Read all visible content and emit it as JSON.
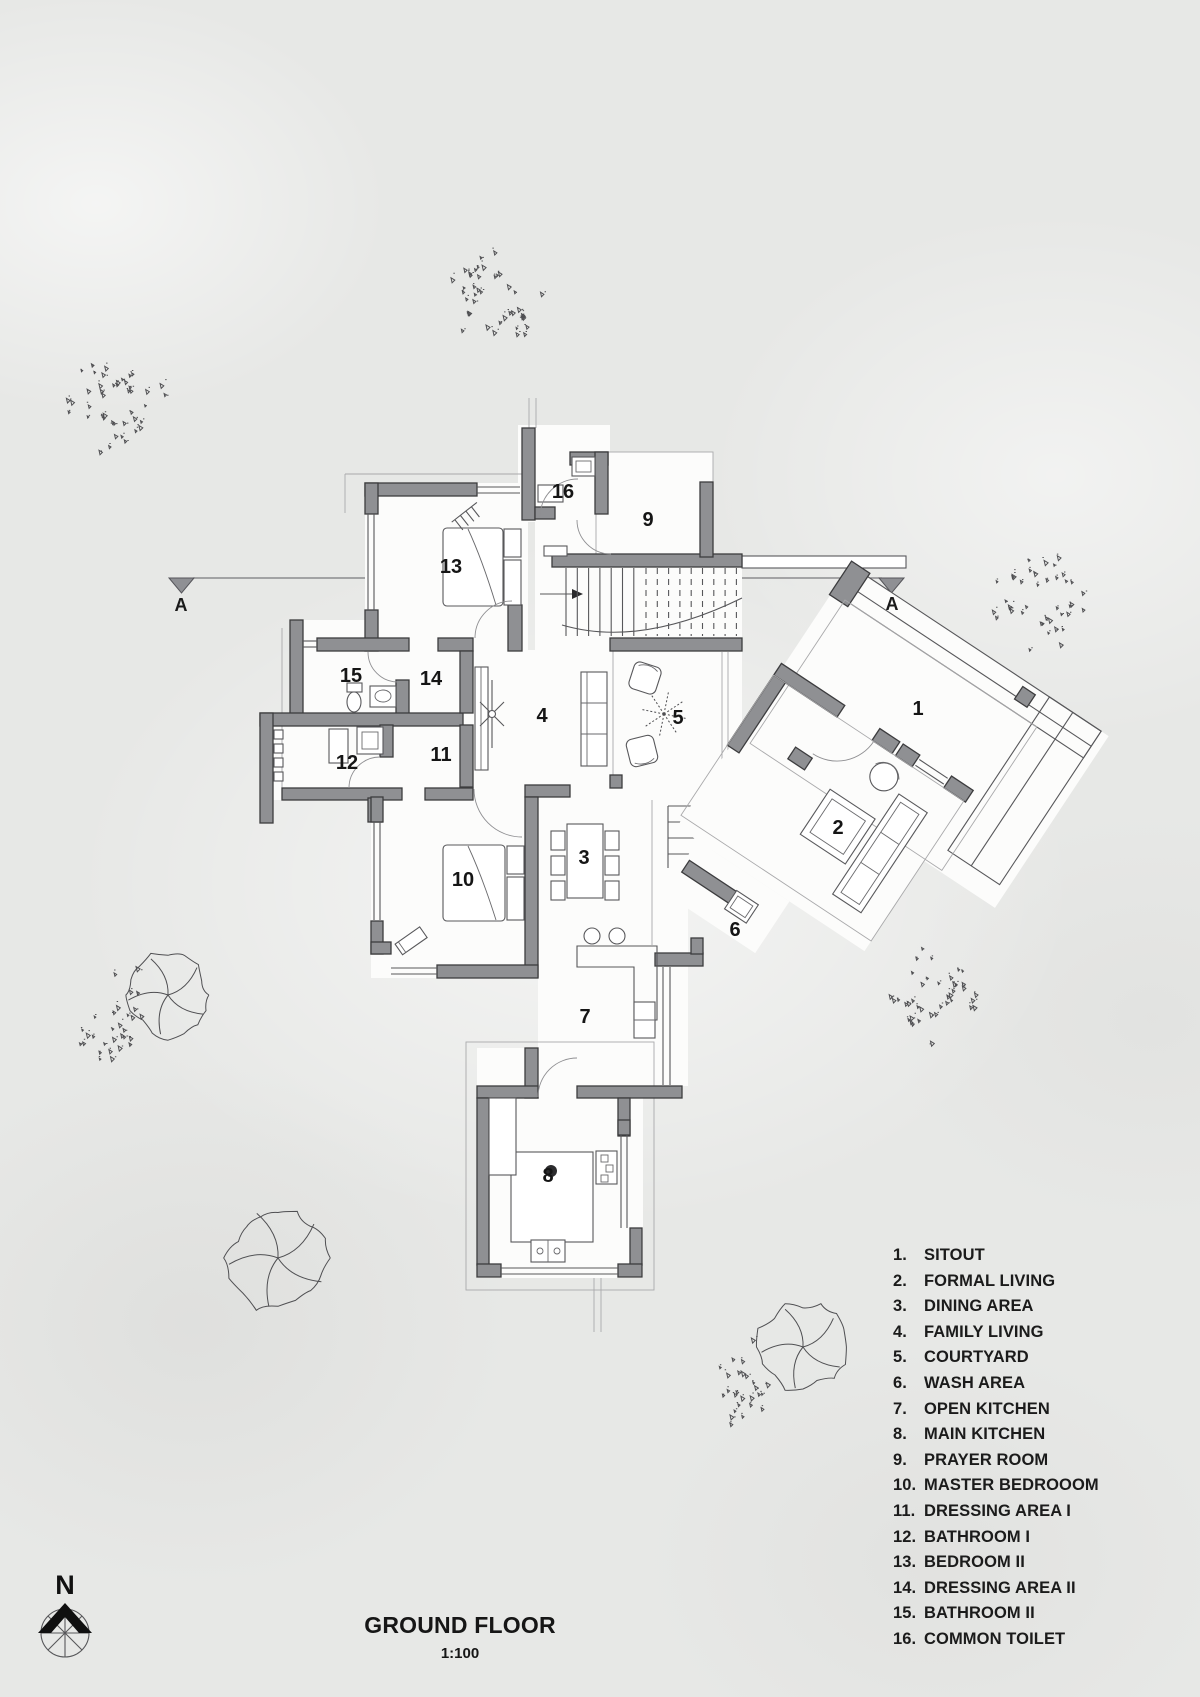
{
  "sheet": {
    "title": "GROUND FLOOR",
    "scale": "1:100",
    "north_label": "N"
  },
  "section_markers": {
    "left": "A",
    "right": "A"
  },
  "legend": {
    "items": [
      {
        "num": "1.",
        "label": "SITOUT"
      },
      {
        "num": "2.",
        "label": "FORMAL LIVING"
      },
      {
        "num": "3.",
        "label": "DINING AREA"
      },
      {
        "num": "4.",
        "label": "FAMILY LIVING"
      },
      {
        "num": "5.",
        "label": "COURTYARD"
      },
      {
        "num": "6.",
        "label": "WASH AREA"
      },
      {
        "num": "7.",
        "label": "OPEN KITCHEN"
      },
      {
        "num": "8.",
        "label": "MAIN KITCHEN"
      },
      {
        "num": "9.",
        "label": "PRAYER ROOM"
      },
      {
        "num": "10.",
        "label": "MASTER BEDROOOM"
      },
      {
        "num": "11.",
        "label": "DRESSING AREA I"
      },
      {
        "num": "12.",
        "label": "BATHROOM I"
      },
      {
        "num": "13.",
        "label": "BEDROOM II"
      },
      {
        "num": "14.",
        "label": "DRESSING AREA II"
      },
      {
        "num": "15.",
        "label": "BATHROOM II"
      },
      {
        "num": "16.",
        "label": "COMMON TOILET"
      }
    ]
  },
  "plan_labels": [
    {
      "text": "1"
    },
    {
      "text": "2"
    },
    {
      "text": "3"
    },
    {
      "text": "4"
    },
    {
      "text": "5"
    },
    {
      "text": "6"
    },
    {
      "text": "7"
    },
    {
      "text": "8"
    },
    {
      "text": "9"
    },
    {
      "text": "10"
    },
    {
      "text": "11"
    },
    {
      "text": "12"
    },
    {
      "text": "13"
    },
    {
      "text": "14"
    },
    {
      "text": "15"
    },
    {
      "text": "16"
    }
  ],
  "colors": {
    "wall_fill": "#8f9093",
    "wall_stroke": "#3c3c3e",
    "marker_fill": "#8f9094",
    "text": "#161616"
  }
}
